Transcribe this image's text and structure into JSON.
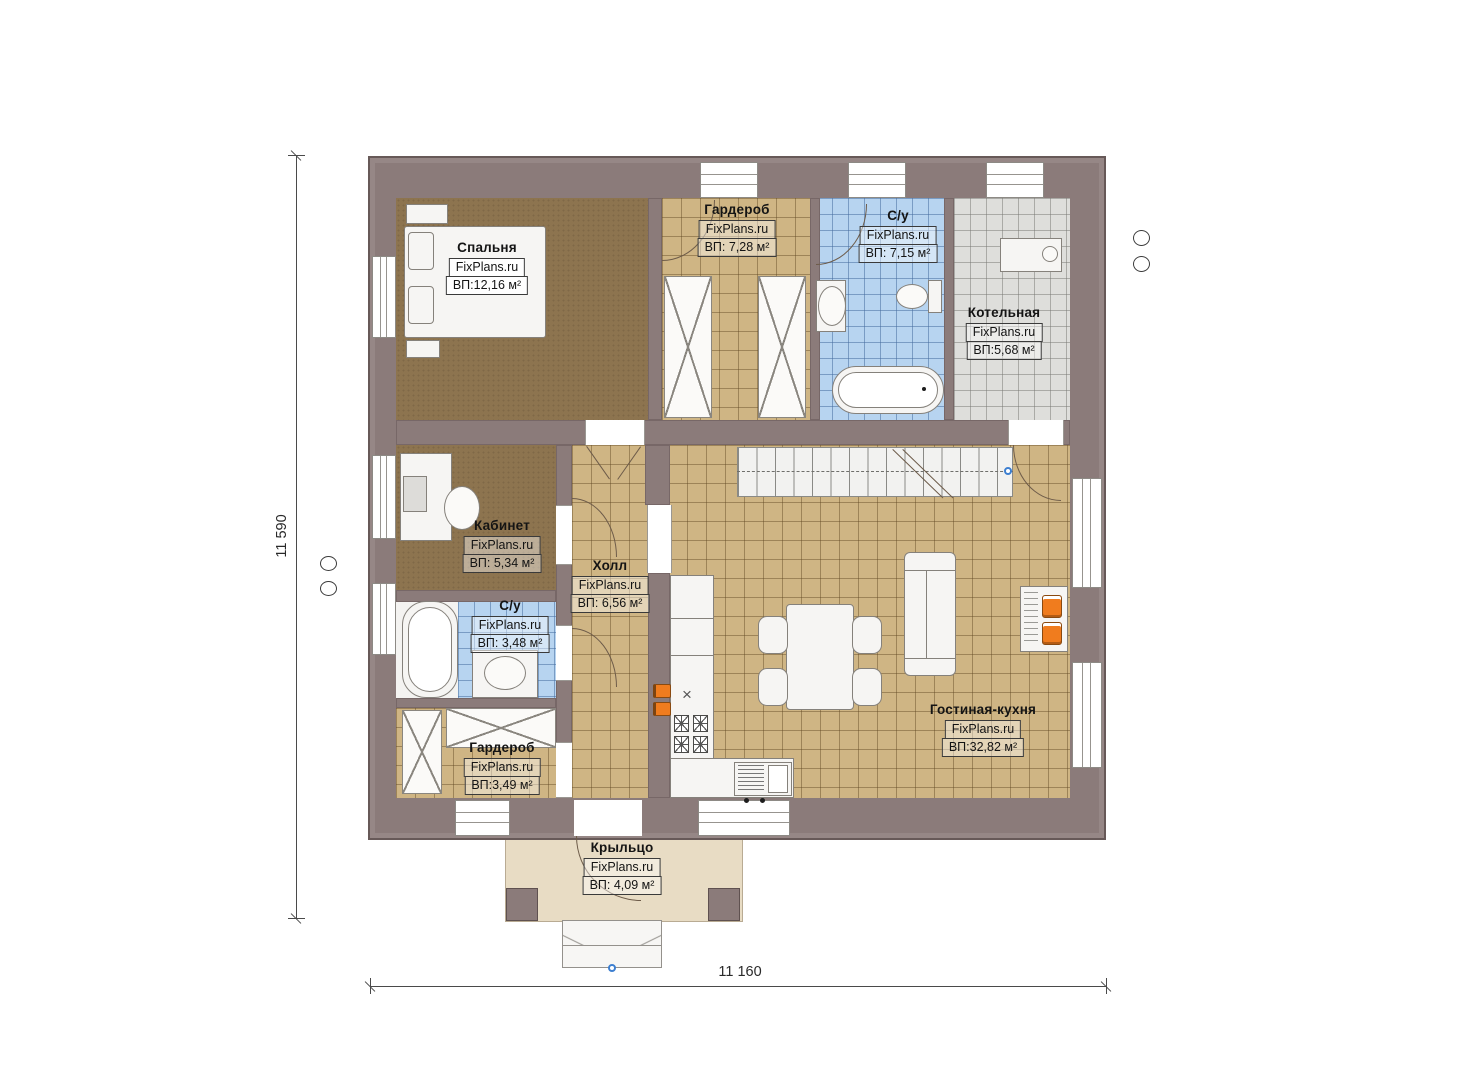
{
  "site_watermark": "FixPlans.ru",
  "dims": {
    "height_label": "11 590",
    "width_label": "11 160"
  },
  "rooms": [
    {
      "id": "bedroom",
      "name": "Спальня",
      "site": "FixPlans.ru",
      "area": "ВП:12,16 м²"
    },
    {
      "id": "wardrobe-top",
      "name": "Гардероб",
      "site": "FixPlans.ru",
      "area": "ВП: 7,28 м²"
    },
    {
      "id": "bathroom-top",
      "name": "С/у",
      "site": "FixPlans.ru",
      "area": "ВП: 7,15 м²"
    },
    {
      "id": "boiler-room",
      "name": "Котельная",
      "site": "FixPlans.ru",
      "area": "ВП:5,68 м²"
    },
    {
      "id": "office",
      "name": "Кабинет",
      "site": "FixPlans.ru",
      "area": "ВП: 5,34 м²"
    },
    {
      "id": "hall",
      "name": "Холл",
      "site": "FixPlans.ru",
      "area": "ВП: 6,56 м²"
    },
    {
      "id": "bathroom-small",
      "name": "С/у",
      "site": "FixPlans.ru",
      "area": "ВП: 3,48 м²"
    },
    {
      "id": "wardrobe-small",
      "name": "Гардероб",
      "site": "FixPlans.ru",
      "area": "ВП:3,49 м²"
    },
    {
      "id": "living-kitchen",
      "name": "Гостиная-кухня",
      "site": "FixPlans.ru",
      "area": "ВП:32,82 м²"
    },
    {
      "id": "porch",
      "name": "Крыльцо",
      "site": "FixPlans.ru",
      "area": "ВП: 4,09 м²"
    }
  ],
  "symbols": {
    "sink_cross": "×"
  },
  "colors": {
    "wall": "#8b7b7a",
    "tile_beige": "#cfb584",
    "tile_blue": "#b7d4f0",
    "tile_gray": "#dededb",
    "carpet": "#8d744f",
    "porch": "#e8dcc4",
    "accent_orange": "#f07c1e",
    "dimension": "#4a4a4a",
    "stairs_dot": "#3d7fd0"
  }
}
